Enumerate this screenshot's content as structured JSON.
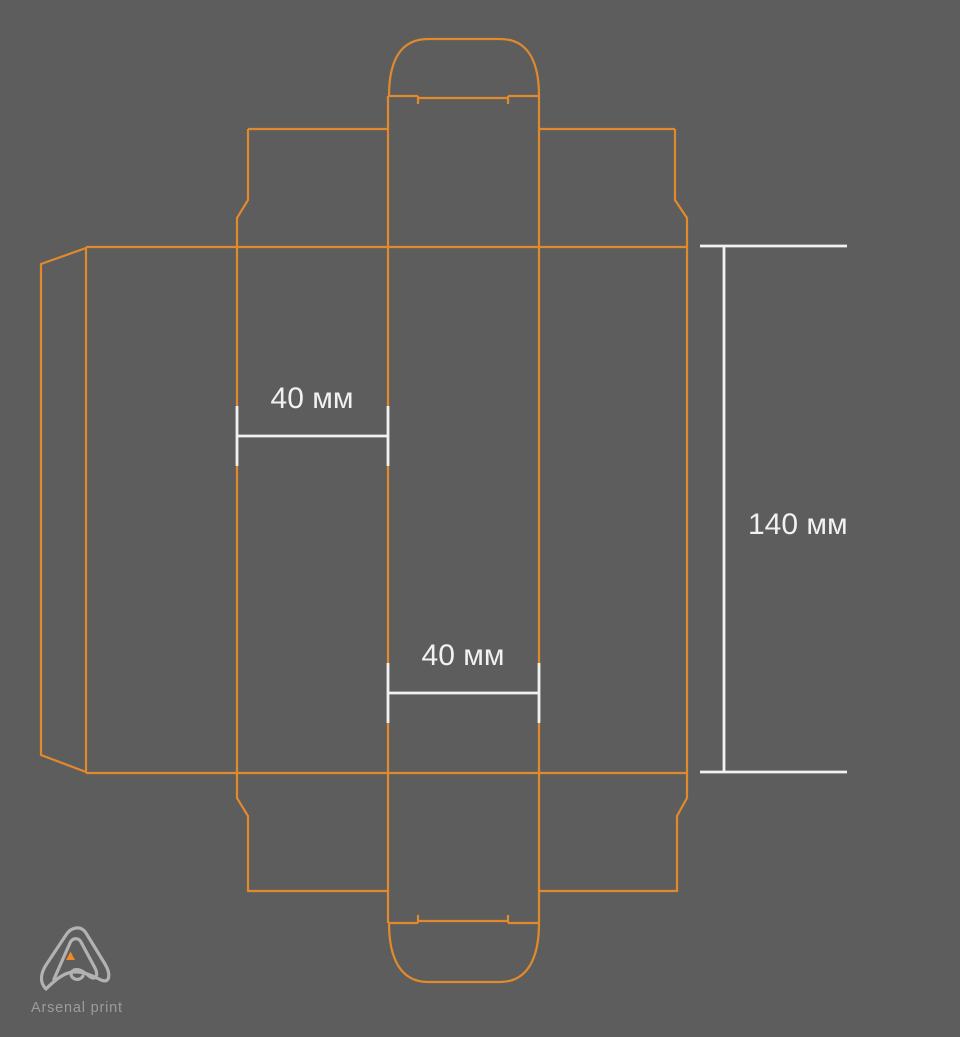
{
  "canvas": {
    "width": 960,
    "height": 1037,
    "background_color": "#5d5d5d"
  },
  "diagram": {
    "type": "packaging-box-dieline",
    "outline_color": "#e18a2c",
    "dimension_color": "#f1f1f1"
  },
  "dimensions": {
    "flap_width_top": "40 мм",
    "flap_width_bottom": "40 мм",
    "body_height": "140 мм"
  },
  "logo": {
    "brand": "Arsenal print",
    "mark_color": "#b2b2b2",
    "accent_color": "#ef8a2b",
    "text_color": "#9c9c9c"
  }
}
